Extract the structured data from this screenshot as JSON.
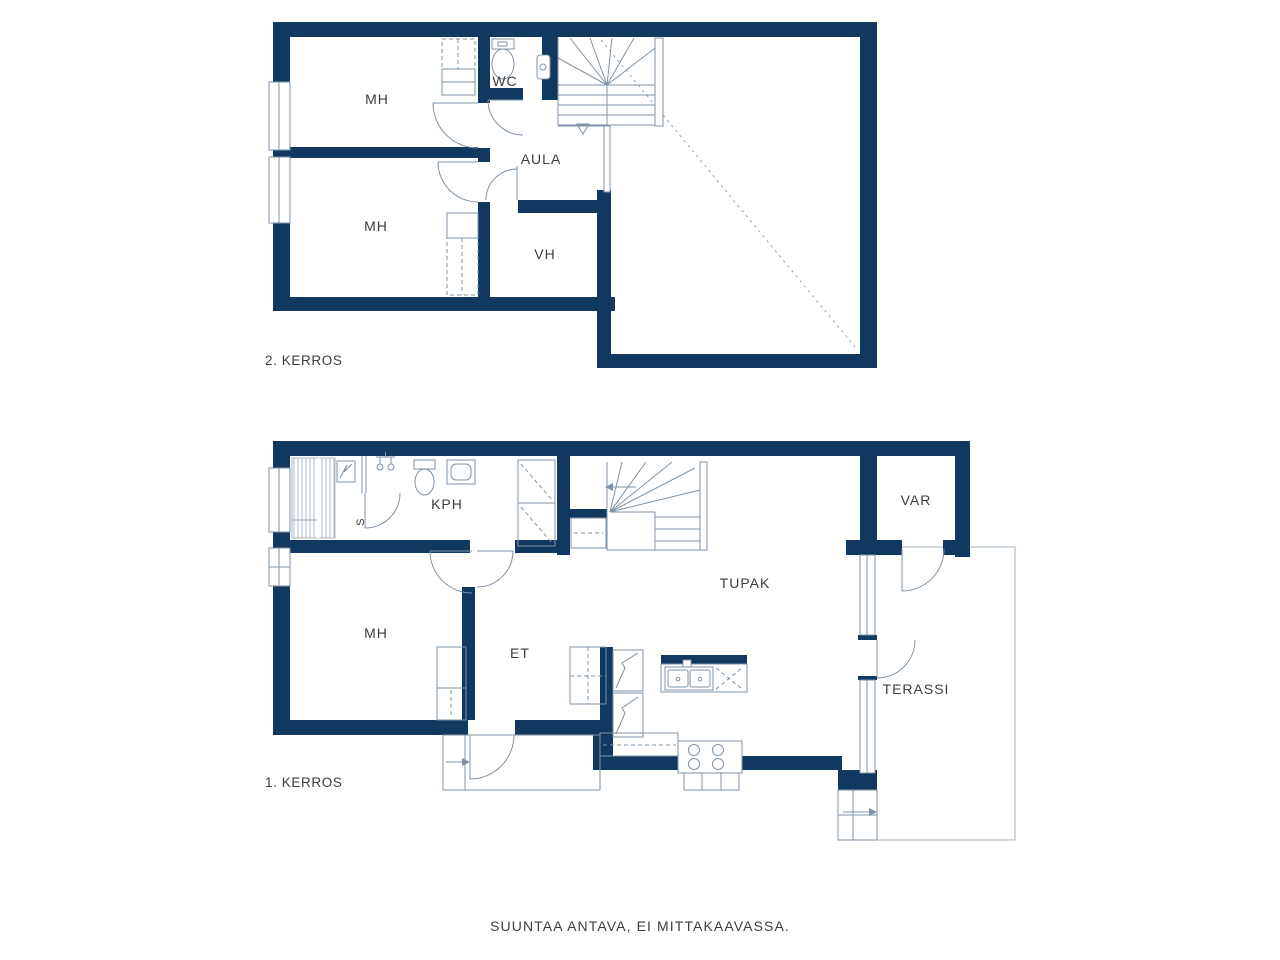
{
  "colors": {
    "wall": "#11395f",
    "line": "#7e93a7",
    "line_light": "#9db0c0",
    "text": "#3d3d3d",
    "dotted": "#93a4b7",
    "bg": "#ffffff"
  },
  "floor2": {
    "floor_label": "2. KERROS",
    "rooms": {
      "mh_top": "MH",
      "wc": "WC",
      "aula": "AULA",
      "mh_bottom": "MH",
      "vh": "VH"
    }
  },
  "floor1": {
    "floor_label": "1. KERROS",
    "rooms": {
      "kph": "KPH",
      "sauna": "S",
      "mh": "MH",
      "et": "ET",
      "tupak": "TUPAK",
      "var": "VAR",
      "terassi": "TERASSI"
    }
  },
  "footer": {
    "disclaimer": "SUUNTAA ANTAVA, EI MITTAKAAVASSA."
  }
}
